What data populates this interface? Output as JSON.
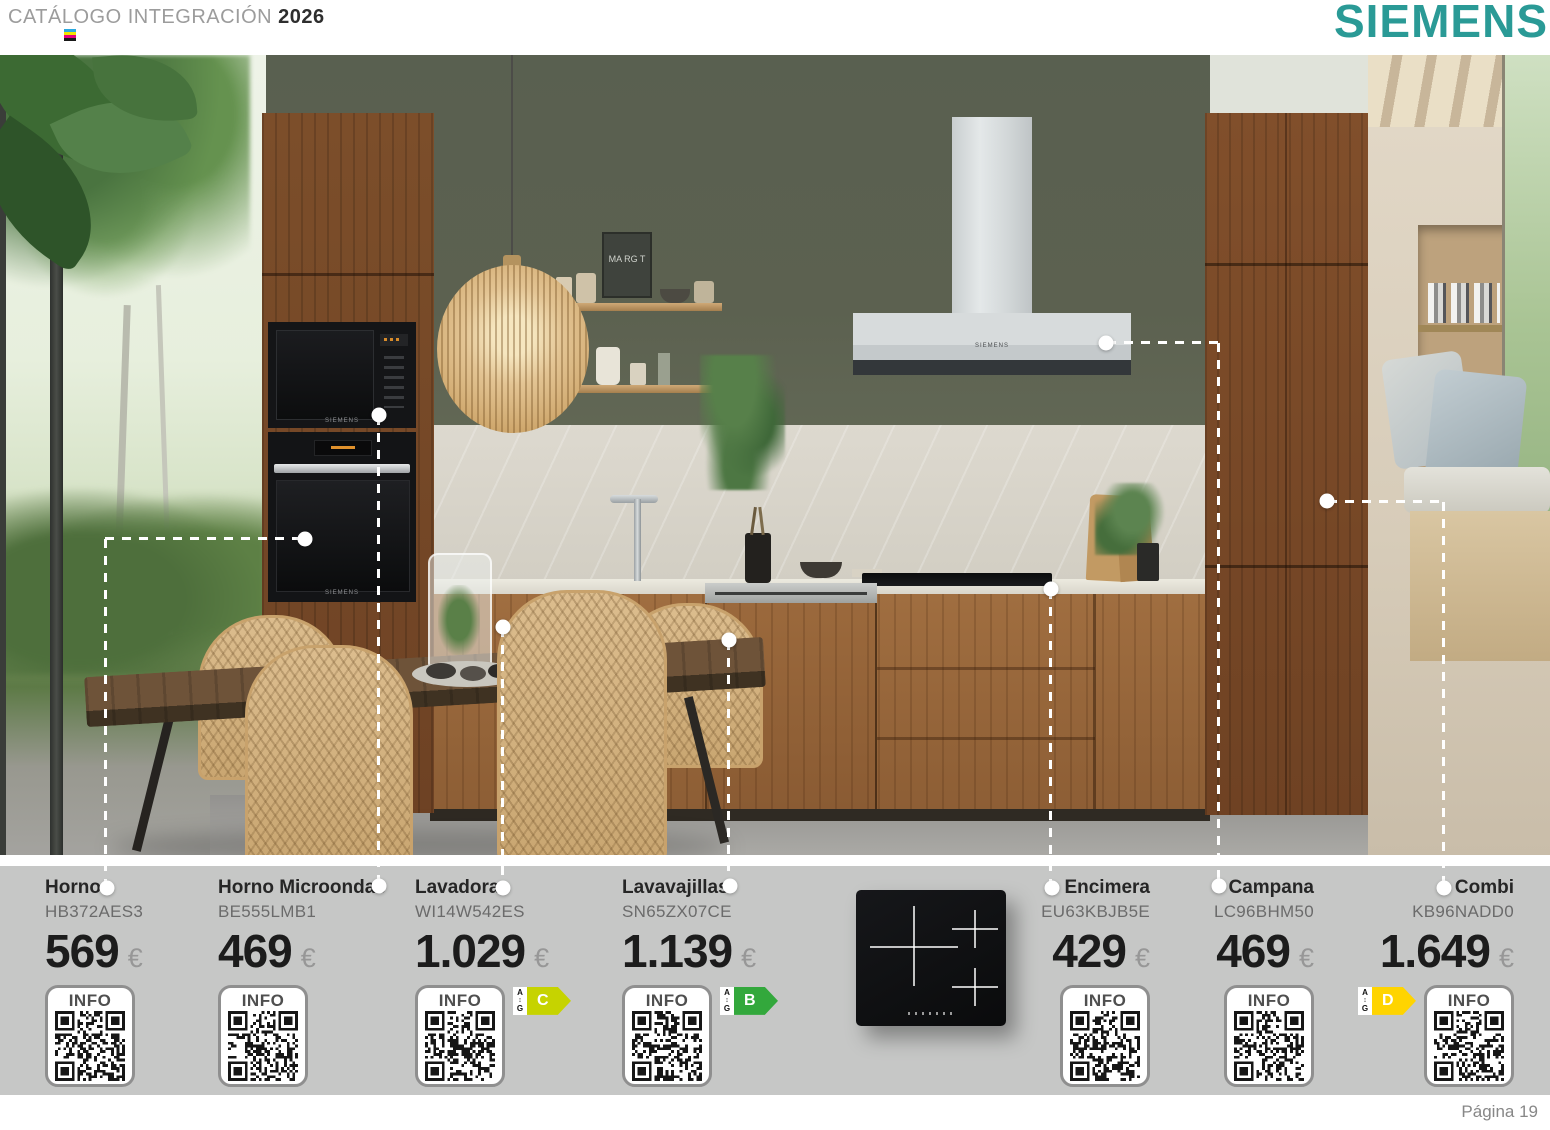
{
  "header": {
    "catalog_title": "CATÁLOGO INTEGRACIÓN",
    "year": "2026",
    "brand": "SIEMENS",
    "brand_color": "#2a9a96"
  },
  "footer": {
    "page_label": "Página 19"
  },
  "colors": {
    "strip_gray": "#c6c7c6",
    "energy_c": "#c6d300",
    "energy_b": "#33a83c",
    "energy_d": "#ffd400",
    "callout_white": "#ffffff"
  },
  "energy_scale": {
    "top": "A",
    "arrow": "↕",
    "bottom": "G"
  },
  "scene": {
    "letter_board": "MA RG T"
  },
  "products": [
    {
      "name": "Horno",
      "ref": "HB372AES3",
      "price": "569",
      "currency": "€",
      "info": "INFO"
    },
    {
      "name": "Horno Microondas",
      "ref": "BE555LMB1",
      "price": "469",
      "currency": "€",
      "info": "INFO"
    },
    {
      "name": "Lavadora",
      "ref": "WI14W542ES",
      "price": "1.029",
      "currency": "€",
      "info": "INFO",
      "energy": "C"
    },
    {
      "name": "Lavavajillas",
      "ref": "SN65ZX07CE",
      "price": "1.139",
      "currency": "€",
      "info": "INFO",
      "energy": "B"
    },
    {
      "name": "Encimera",
      "ref": "EU63KBJB5E",
      "price": "429",
      "currency": "€",
      "info": "INFO"
    },
    {
      "name": "Campana",
      "ref": "LC96BHM50",
      "price": "469",
      "currency": "€",
      "info": "INFO"
    },
    {
      "name": "Combi",
      "ref": "KB96NADD0",
      "price": "1.649",
      "currency": "€",
      "info": "INFO",
      "energy": "D"
    }
  ]
}
